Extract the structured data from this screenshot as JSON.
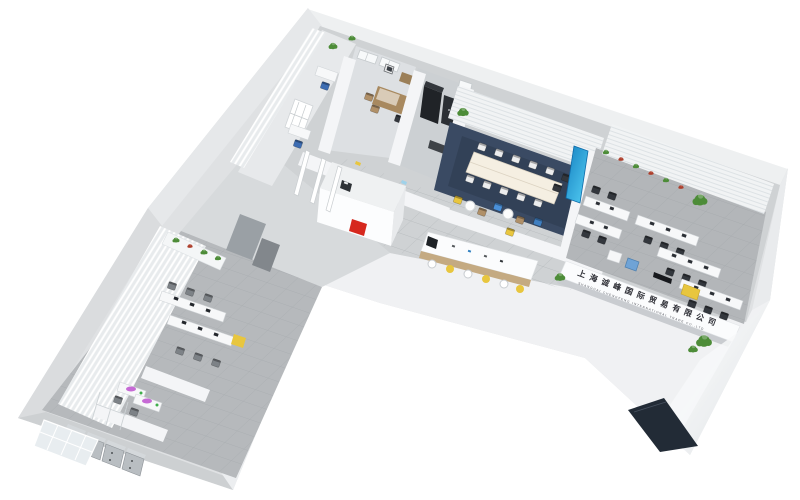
{
  "sign": {
    "line1": "上海诚峰国际贸易有限公司",
    "line2": "SHANGHAI CHENGFENG INTERNATIONAL TRADE CO.,LTD"
  },
  "colors": {
    "background": "#ffffff",
    "logo_red": "#d6281e",
    "screen_blue": "#29a0dc",
    "accent_yellow": "#e8c63e",
    "accent_blue": "#4a90d9",
    "chair_blue": "#3f79c9",
    "sofa_blue": "#6fa3d6",
    "carpet_navy": "#3a4a63",
    "mat_navy": "#222b36",
    "plant_green": "#4d8c38",
    "flower_red": "#ad3f2c",
    "wood": "#a8895f",
    "wood_light": "#c4aa82",
    "dark_cabinet": "#202327",
    "screen_purple": "#c05ad0",
    "sign_text": "#2e2f36"
  }
}
